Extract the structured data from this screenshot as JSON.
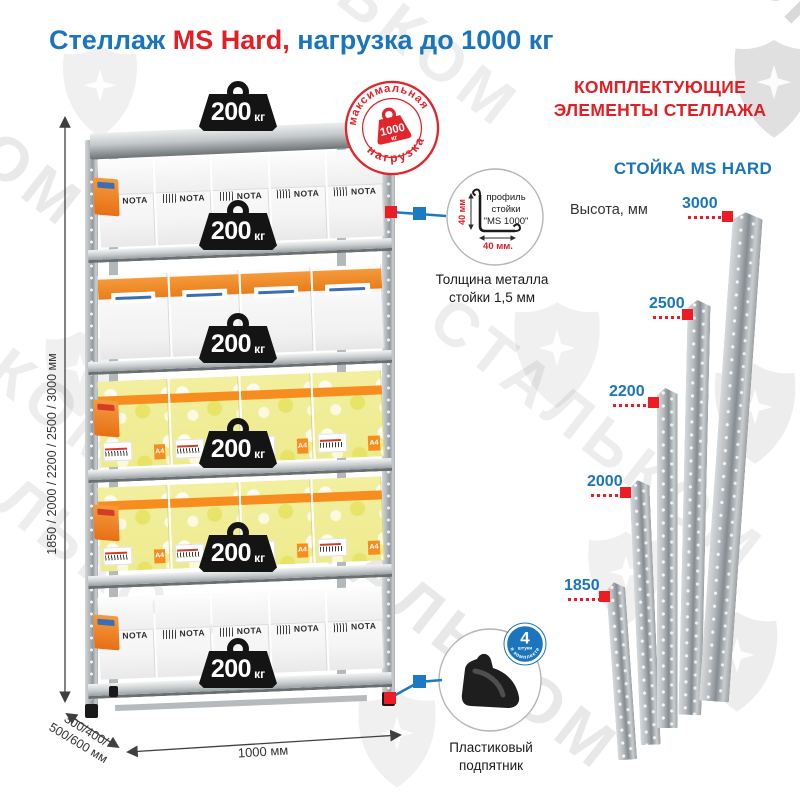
{
  "title": {
    "text_blue_1": "Стеллаж ",
    "text_red": "MS Hard,",
    "text_blue_2": " нагрузка до 1000 кг"
  },
  "watermark": {
    "brand": "СТАЛЬКОМ"
  },
  "rack": {
    "shelf_weight": {
      "value": "200",
      "unit": "кг"
    },
    "stamp": {
      "arc_top": "максимальная",
      "arc_bottom": "нагрузка",
      "value": "1000",
      "unit": "кг"
    },
    "dims": {
      "heights": "1850 / 2000 / 2200 / 2500 / 3000 мм",
      "depth_line1": "300/400/",
      "depth_line2": "500/600 мм",
      "width": "1000 мм"
    },
    "boxes": {
      "brand": "NOTA",
      "a4": "A4"
    },
    "levels": [
      {
        "type": "nota",
        "count": 5
      },
      {
        "type": "orange",
        "count": 4
      },
      {
        "type": "yellow",
        "count": 4
      },
      {
        "type": "yellow",
        "count": 4
      },
      {
        "type": "nota",
        "count": 5
      }
    ]
  },
  "profile": {
    "line1": "профиль",
    "line2": "стойки",
    "line3": "\"MS 1000\"",
    "dim_vertical": "40 мм",
    "dim_horizontal": "40 мм.",
    "thickness_line1": "Толщина металла",
    "thickness_line2": "стойки 1,5 мм"
  },
  "components": {
    "header_line1": "КОМПЛЕКТУЮЩИЕ",
    "header_line2": "ЭЛЕМЕНТЫ СТЕЛЛАЖА",
    "subheader": "СТОЙКА MS HARD",
    "height_label": "Высота, мм",
    "uprights": [
      {
        "height": "1850"
      },
      {
        "height": "2000"
      },
      {
        "height": "2200"
      },
      {
        "height": "2500"
      },
      {
        "height": "3000"
      }
    ]
  },
  "foot": {
    "badge_value": "4",
    "badge_unit": "штуки",
    "badge_arc": "в комплекте",
    "label_line1": "Пластиковый",
    "label_line2": "подпятник"
  },
  "colors": {
    "blue": "#1B75BC",
    "red": "#E31E24",
    "accent_red": "#ED1C24",
    "steel": "#b7bcc0"
  }
}
